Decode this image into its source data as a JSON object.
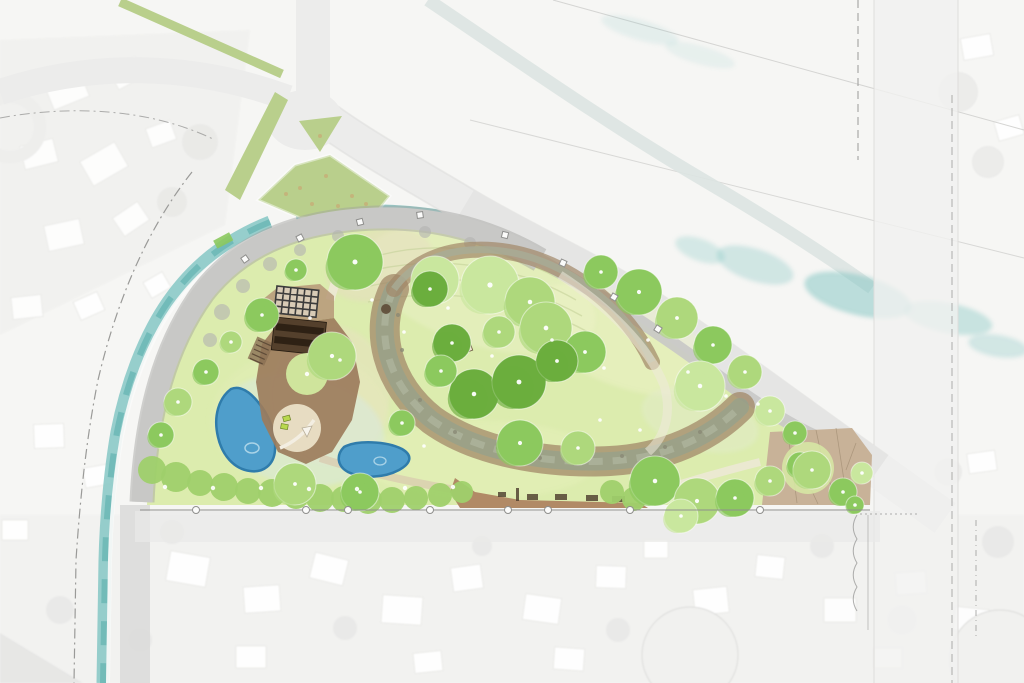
{
  "meta": {
    "drawing_type": "watercolor-landscape-site-plan",
    "features": [
      "flood-control-channel",
      "curved-promenade",
      "community-pavilion",
      "pergola",
      "west-pond",
      "east-pond",
      "dry-creek",
      "meadow",
      "lawn",
      "hedge-row",
      "picnic-walkway",
      "east-plaza",
      "street-junction",
      "residential-context"
    ]
  },
  "palette": {
    "bg": "#f6f6f4",
    "context_house": "#ffffff",
    "context_shadow": "#e2e2df",
    "road": "#ececeb",
    "road_edge": "#d3d3d1",
    "canal": "#7fc4c1",
    "canal_deep": "#54aca9",
    "channel_pale": "#dde4e2",
    "promenade": "#c8c8c6",
    "promenade_edge": "#9b9b99",
    "lawn": "#dcecae",
    "meadow": "#e9f0c4",
    "tree_pale": "#c9e79e",
    "tree_light": "#aed87c",
    "tree_mid": "#8cc95e",
    "tree_dark": "#6cae3e",
    "shrub": "#9fd06b",
    "pond": "#4f9ecb",
    "pond_edge": "#2f7cab",
    "pond_light": "#bfe0ee",
    "creek_bank": "#a18868",
    "creek_bed": "#99a189",
    "deck": "#9c7c5c",
    "deck_light": "#b69878",
    "sand": "#e7dcc2",
    "roof": "#54402c",
    "roof_dark": "#2e2114",
    "pergola": "#3c3c3c",
    "plaza": "#c8b298",
    "plaza_joint": "#9e8a70",
    "path_light": "#efe9da",
    "moss": "#b9cf8c",
    "marker": "#8f8f8d",
    "dg_path": "#b18a66",
    "lime": "#b9d84e"
  },
  "plan": {
    "trees": [
      [
        355,
        262,
        28,
        "mid"
      ],
      [
        435,
        280,
        24,
        "pale"
      ],
      [
        296,
        270,
        11,
        "mid"
      ],
      [
        262,
        315,
        17,
        "mid"
      ],
      [
        231,
        342,
        11,
        "light"
      ],
      [
        332,
        356,
        24,
        "light"
      ],
      [
        430,
        289,
        18,
        "dark"
      ],
      [
        452,
        343,
        19,
        "dark"
      ],
      [
        490,
        285,
        29,
        "pale"
      ],
      [
        530,
        302,
        25,
        "light"
      ],
      [
        499,
        332,
        16,
        "light"
      ],
      [
        546,
        328,
        26,
        "light"
      ],
      [
        585,
        352,
        21,
        "mid"
      ],
      [
        601,
        272,
        17,
        "mid"
      ],
      [
        639,
        292,
        23,
        "mid"
      ],
      [
        677,
        318,
        21,
        "light"
      ],
      [
        713,
        345,
        19,
        "mid"
      ],
      [
        745,
        372,
        17,
        "light"
      ],
      [
        700,
        386,
        25,
        "pale"
      ],
      [
        474,
        394,
        25,
        "dark"
      ],
      [
        519,
        382,
        27,
        "dark"
      ],
      [
        557,
        361,
        21,
        "dark"
      ],
      [
        441,
        371,
        16,
        "mid"
      ],
      [
        206,
        372,
        13,
        "mid"
      ],
      [
        178,
        402,
        14,
        "light"
      ],
      [
        161,
        435,
        13,
        "mid"
      ],
      [
        402,
        423,
        13,
        "mid"
      ],
      [
        520,
        443,
        23,
        "mid"
      ],
      [
        578,
        448,
        17,
        "light"
      ],
      [
        655,
        481,
        25,
        "mid"
      ],
      [
        697,
        501,
        23,
        "light"
      ],
      [
        735,
        498,
        19,
        "mid"
      ],
      [
        770,
        481,
        15,
        "light"
      ],
      [
        800,
        465,
        13,
        "mid"
      ],
      [
        681,
        516,
        17,
        "pale"
      ],
      [
        812,
        470,
        19,
        "light"
      ],
      [
        843,
        492,
        14,
        "mid"
      ],
      [
        862,
        473,
        11,
        "pale"
      ],
      [
        770,
        411,
        15,
        "pale"
      ],
      [
        795,
        433,
        12,
        "mid"
      ],
      [
        855,
        505,
        9,
        "mid"
      ],
      [
        295,
        484,
        21,
        "light"
      ],
      [
        360,
        492,
        19,
        "mid"
      ]
    ],
    "hedge": [
      [
        152,
        470,
        14
      ],
      [
        176,
        477,
        15
      ],
      [
        200,
        483,
        13
      ],
      [
        224,
        487,
        14
      ],
      [
        248,
        491,
        13
      ],
      [
        272,
        493,
        14
      ],
      [
        296,
        496,
        13
      ],
      [
        320,
        498,
        14
      ],
      [
        344,
        499,
        13
      ],
      [
        368,
        500,
        14
      ],
      [
        392,
        500,
        13
      ],
      [
        416,
        498,
        12
      ],
      [
        440,
        495,
        12
      ],
      [
        462,
        492,
        11
      ],
      [
        612,
        492,
        12
      ],
      [
        634,
        499,
        12
      ]
    ],
    "context_houses": [
      [
        48,
        78,
        38,
        26,
        -22
      ],
      [
        112,
        62,
        30,
        22,
        -28
      ],
      [
        22,
        142,
        34,
        24,
        -14
      ],
      [
        84,
        150,
        40,
        28,
        -30
      ],
      [
        148,
        124,
        26,
        20,
        -20
      ],
      [
        46,
        222,
        36,
        26,
        -12
      ],
      [
        116,
        208,
        30,
        22,
        -34
      ],
      [
        12,
        296,
        30,
        22,
        -6
      ],
      [
        76,
        296,
        26,
        20,
        -24
      ],
      [
        146,
        276,
        22,
        18,
        -30
      ],
      [
        34,
        424,
        30,
        24,
        -2
      ],
      [
        84,
        466,
        26,
        20,
        -10
      ],
      [
        2,
        520,
        26,
        20,
        0
      ],
      [
        168,
        554,
        40,
        30,
        10
      ],
      [
        244,
        586,
        36,
        26,
        -4
      ],
      [
        312,
        556,
        34,
        26,
        14
      ],
      [
        382,
        596,
        40,
        28,
        4
      ],
      [
        452,
        566,
        30,
        24,
        -8
      ],
      [
        524,
        596,
        36,
        26,
        8
      ],
      [
        596,
        566,
        30,
        22,
        2
      ],
      [
        694,
        588,
        34,
        26,
        -6
      ],
      [
        756,
        556,
        28,
        22,
        6
      ],
      [
        824,
        598,
        32,
        24,
        0
      ],
      [
        896,
        572,
        30,
        22,
        -4
      ],
      [
        954,
        608,
        34,
        24,
        6
      ],
      [
        236,
        646,
        30,
        22,
        0
      ],
      [
        414,
        652,
        28,
        20,
        -6
      ],
      [
        554,
        648,
        30,
        22,
        4
      ],
      [
        874,
        648,
        28,
        20,
        0
      ],
      [
        644,
        540,
        24,
        18,
        0
      ],
      [
        962,
        36,
        30,
        22,
        -10
      ],
      [
        996,
        118,
        26,
        20,
        -16
      ],
      [
        968,
        452,
        28,
        20,
        -8
      ]
    ],
    "context_blobs": [
      [
        200,
        142,
        18
      ],
      [
        172,
        202,
        15
      ],
      [
        232,
        252,
        12
      ],
      [
        958,
        92,
        20
      ],
      [
        988,
        162,
        16
      ],
      [
        172,
        532,
        12
      ],
      [
        482,
        546,
        10
      ],
      [
        822,
        546,
        12
      ],
      [
        948,
        472,
        14
      ],
      [
        998,
        542,
        16
      ],
      [
        902,
        620,
        14
      ],
      [
        618,
        630,
        12
      ],
      [
        345,
        628,
        12
      ],
      [
        60,
        610,
        14
      ],
      [
        140,
        640,
        12
      ]
    ],
    "water_patches": [
      [
        755,
        265,
        40,
        16,
        18,
        0.32
      ],
      [
        858,
        295,
        55,
        20,
        14,
        0.5
      ],
      [
        948,
        318,
        45,
        15,
        11,
        0.38
      ],
      [
        998,
        346,
        30,
        11,
        9,
        0.3
      ],
      [
        700,
        250,
        26,
        11,
        20,
        0.28
      ],
      [
        640,
        30,
        40,
        10,
        16,
        0.15
      ],
      [
        700,
        55,
        36,
        9,
        16,
        0.12
      ]
    ],
    "lawn_dots": [
      [
        165,
        487
      ],
      [
        213,
        488
      ],
      [
        261,
        488
      ],
      [
        309,
        489
      ],
      [
        357,
        489
      ],
      [
        405,
        488
      ],
      [
        453,
        487
      ]
    ],
    "meadow_dots": [
      [
        404,
        332
      ],
      [
        448,
        308
      ],
      [
        492,
        356
      ],
      [
        552,
        340
      ],
      [
        604,
        368
      ],
      [
        648,
        340
      ],
      [
        688,
        372
      ],
      [
        726,
        396
      ],
      [
        758,
        404
      ],
      [
        372,
        300
      ],
      [
        340,
        360
      ],
      [
        424,
        446
      ],
      [
        310,
        318
      ],
      [
        600,
        420
      ],
      [
        640,
        430
      ]
    ],
    "boundary_markers": [
      [
        196,
        510
      ],
      [
        306,
        510
      ],
      [
        348,
        510
      ],
      [
        430,
        510
      ],
      [
        508,
        510
      ],
      [
        548,
        510
      ],
      [
        630,
        510
      ],
      [
        760,
        510
      ]
    ],
    "promenade_markers": [
      [
        245,
        259,
        -35
      ],
      [
        300,
        238,
        -28
      ],
      [
        360,
        222,
        -15
      ],
      [
        420,
        215,
        -8
      ],
      [
        505,
        235,
        14
      ],
      [
        563,
        263,
        25
      ],
      [
        614,
        297,
        30
      ],
      [
        658,
        329,
        32
      ]
    ],
    "creek_rocks": [
      [
        420,
        400
      ],
      [
        455,
        432
      ],
      [
        498,
        448
      ],
      [
        540,
        458
      ],
      [
        578,
        460
      ],
      [
        622,
        456
      ],
      [
        665,
        447
      ],
      [
        700,
        432
      ],
      [
        402,
        350
      ],
      [
        398,
        315
      ]
    ],
    "island_speckles": [
      [
        300,
        188
      ],
      [
        326,
        176
      ],
      [
        352,
        196
      ],
      [
        312,
        204
      ],
      [
        286,
        194
      ],
      [
        338,
        206
      ],
      [
        366,
        204
      ],
      [
        320,
        136
      ]
    ],
    "plaza_joints": [
      [
        788,
        434,
        797,
        503
      ],
      [
        816,
        430,
        824,
        468
      ],
      [
        836,
        428,
        847,
        500
      ],
      [
        856,
        443,
        846,
        470
      ],
      [
        802,
        470,
        818,
        504
      ],
      [
        826,
        470,
        836,
        502
      ]
    ],
    "walkway_furniture": [
      [
        516,
        488,
        3,
        13
      ],
      [
        527,
        494,
        11,
        6
      ],
      [
        555,
        494,
        12,
        6
      ],
      [
        586,
        495,
        12,
        6
      ],
      [
        612,
        496,
        13,
        6
      ],
      [
        498,
        492,
        8,
        5
      ]
    ],
    "promenade_blobs": [
      [
        222,
        312,
        8
      ],
      [
        243,
        286,
        7
      ],
      [
        270,
        264,
        7
      ],
      [
        300,
        250,
        6
      ],
      [
        338,
        236,
        6
      ],
      [
        210,
        340,
        7
      ],
      [
        425,
        232,
        6
      ],
      [
        470,
        243,
        6
      ],
      [
        205,
        368,
        6
      ]
    ]
  }
}
